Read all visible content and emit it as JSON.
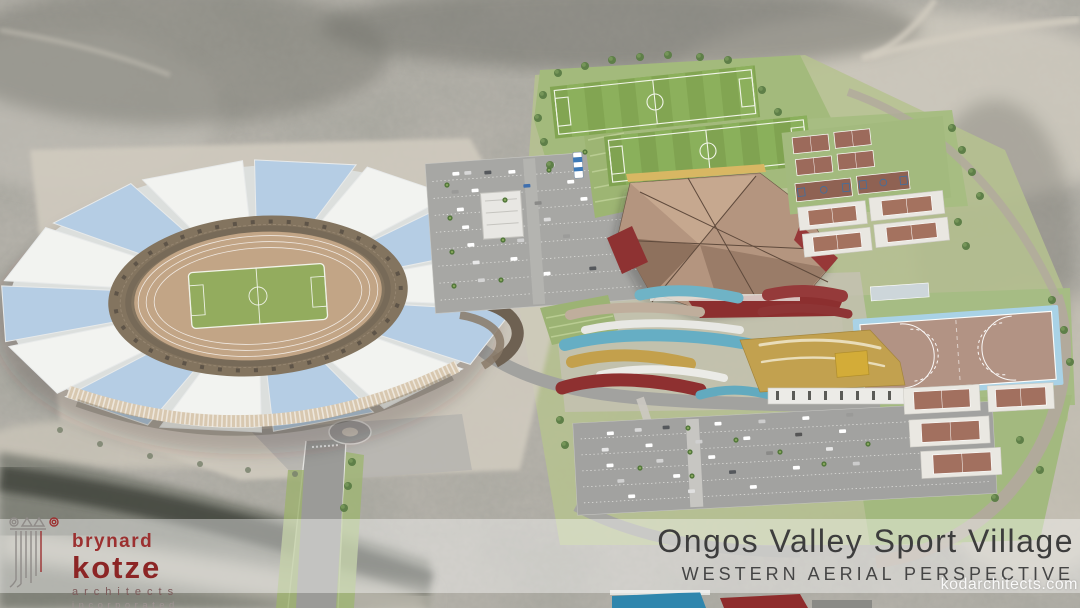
{
  "caption": {
    "title": "Ongos Valley Sport Village",
    "subtitle": "WESTERN AERIAL PERSPECTIVE"
  },
  "watermark": {
    "text": "kodarchitects.com"
  },
  "logo": {
    "name_line1": "brynard",
    "name_line2": "kotze",
    "descriptor_line1": "architects",
    "descriptor_line2": "incorporated"
  },
  "palette": {
    "brand_red": "#8c2525",
    "canopy_blue": "#b5cde4",
    "canopy_white": "#f2f3f0",
    "pitch_green": "#82a552",
    "track_tan": "#c2a586",
    "hockey_border_blue": "#a9d2e6",
    "roof_maroon": "#953a3a",
    "roof_teal": "#66aec4",
    "roof_gold": "#c2a14f",
    "terrain_gray": "#b5b2aa",
    "caption_text": "#3d3d3d"
  },
  "scene": {
    "type": "architectural-aerial-render",
    "features": [
      "stadium-with-canopy-roof",
      "athletics-track",
      "soccer-pitches",
      "indoor-sports-hall",
      "tennis-courts",
      "basketball-courts",
      "hockey-field",
      "clubhouse-buildings",
      "parking-lots",
      "access-roads",
      "roundabout",
      "ravine"
    ]
  }
}
